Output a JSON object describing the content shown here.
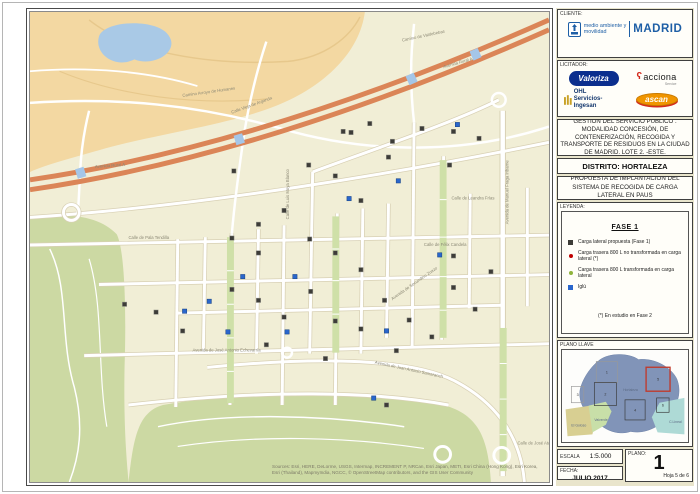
{
  "map": {
    "attribution": "Sources: Esri, HERE, DeLorme, USGS, Intermap, INCREMENT P, NRCan, Esri Japan, METI, Esri China (Hong Kong), Esri Korea, Esri (Thailand), MapmyIndia, NGCC, © OpenStreetMap contributors, and the GIS User Community",
    "colors": {
      "base": "#f1eed6",
      "golf": "#f3d8a2",
      "pond": "#a9c9e6",
      "park": "#ccd9a3",
      "highway": "#db8557",
      "road_casing": "#d8d0b4",
      "marker_dark": "#3d3c38",
      "marker_blue": "#2a66cc"
    },
    "street_labels": [
      {
        "text": "Camino Arroyo de Humanes",
        "x": 155,
        "y": 86,
        "r": -8
      },
      {
        "text": "Camino de Valdebebas",
        "x": 378,
        "y": 30,
        "r": -12
      },
      {
        "text": "Avenida Rural A",
        "x": 66,
        "y": 158,
        "r": -4
      },
      {
        "text": "Avenida Rural A",
        "x": 420,
        "y": 57,
        "r": -16
      },
      {
        "text": "Calle Vieja de Arganda",
        "x": 205,
        "y": 103,
        "r": -20
      },
      {
        "text": "Calle de Pala Tendilla",
        "x": 100,
        "y": 230,
        "r": 0
      },
      {
        "text": "Calle de Leandra Frías",
        "x": 428,
        "y": 190,
        "r": 0
      },
      {
        "text": "Calle de Félix Candela",
        "x": 400,
        "y": 237,
        "r": 0
      },
      {
        "text": "Avenida de Manuel Fraga Iribarne",
        "x": 486,
        "y": 215,
        "r": -90
      },
      {
        "text": "Calle de Luis Moya Blanco",
        "x": 263,
        "y": 210,
        "r": -90
      },
      {
        "text": "Avenida de José Antonio Echevarría",
        "x": 165,
        "y": 344,
        "r": 0
      },
      {
        "text": "Avenida de Juan Antonio Samaranch",
        "x": 350,
        "y": 356,
        "r": 12
      },
      {
        "text": "Avenida de Secundino Zuazo",
        "x": 368,
        "y": 292,
        "r": -35
      },
      {
        "text": "Calle de José Atarés",
        "x": 495,
        "y": 438,
        "r": 0
      }
    ],
    "markers": [
      {
        "type": "carga_lateral",
        "x": 318,
        "y": 121
      },
      {
        "type": "carga_lateral",
        "x": 326,
        "y": 122
      },
      {
        "type": "carga_lateral",
        "x": 345,
        "y": 113
      },
      {
        "type": "carga_lateral",
        "x": 364,
        "y": 147
      },
      {
        "type": "carga_lateral",
        "x": 368,
        "y": 131
      },
      {
        "type": "carga_lateral",
        "x": 398,
        "y": 118
      },
      {
        "type": "carga_lateral",
        "x": 430,
        "y": 121
      },
      {
        "type": "carga_lateral",
        "x": 426,
        "y": 155
      },
      {
        "type": "carga_lateral",
        "x": 456,
        "y": 128
      },
      {
        "type": "carga_lateral",
        "x": 283,
        "y": 155
      },
      {
        "type": "carga_lateral",
        "x": 310,
        "y": 166
      },
      {
        "type": "carga_lateral",
        "x": 336,
        "y": 191
      },
      {
        "type": "carga_lateral",
        "x": 258,
        "y": 201
      },
      {
        "type": "carga_lateral",
        "x": 232,
        "y": 215
      },
      {
        "type": "carga_lateral",
        "x": 205,
        "y": 229
      },
      {
        "type": "carga_lateral",
        "x": 232,
        "y": 244
      },
      {
        "type": "carga_lateral",
        "x": 284,
        "y": 230
      },
      {
        "type": "carga_lateral",
        "x": 310,
        "y": 244
      },
      {
        "type": "carga_lateral",
        "x": 336,
        "y": 261
      },
      {
        "type": "carga_lateral",
        "x": 205,
        "y": 281
      },
      {
        "type": "carga_lateral",
        "x": 232,
        "y": 292
      },
      {
        "type": "carga_lateral",
        "x": 258,
        "y": 309
      },
      {
        "type": "carga_lateral",
        "x": 285,
        "y": 283
      },
      {
        "type": "carga_lateral",
        "x": 310,
        "y": 313
      },
      {
        "type": "carga_lateral",
        "x": 336,
        "y": 321
      },
      {
        "type": "carga_lateral",
        "x": 360,
        "y": 292
      },
      {
        "type": "carga_lateral",
        "x": 385,
        "y": 312
      },
      {
        "type": "carga_lateral",
        "x": 408,
        "y": 329
      },
      {
        "type": "carga_lateral",
        "x": 430,
        "y": 247
      },
      {
        "type": "carga_lateral",
        "x": 430,
        "y": 279
      },
      {
        "type": "carga_lateral",
        "x": 452,
        "y": 301
      },
      {
        "type": "carga_lateral",
        "x": 468,
        "y": 263
      },
      {
        "type": "carga_lateral",
        "x": 372,
        "y": 343
      },
      {
        "type": "carga_lateral",
        "x": 300,
        "y": 351
      },
      {
        "type": "carga_lateral",
        "x": 240,
        "y": 337
      },
      {
        "type": "carga_lateral",
        "x": 155,
        "y": 323
      },
      {
        "type": "carga_lateral",
        "x": 128,
        "y": 304
      },
      {
        "type": "carga_lateral",
        "x": 207,
        "y": 161
      },
      {
        "type": "carga_lateral",
        "x": 96,
        "y": 296
      },
      {
        "type": "carga_lateral",
        "x": 362,
        "y": 398
      },
      {
        "type": "iglu",
        "x": 182,
        "y": 293
      },
      {
        "type": "iglu",
        "x": 157,
        "y": 303
      },
      {
        "type": "iglu",
        "x": 201,
        "y": 324
      },
      {
        "type": "iglu",
        "x": 261,
        "y": 324
      },
      {
        "type": "iglu",
        "x": 362,
        "y": 323
      },
      {
        "type": "iglu",
        "x": 349,
        "y": 391
      },
      {
        "type": "iglu",
        "x": 416,
        "y": 246
      },
      {
        "type": "iglu",
        "x": 216,
        "y": 268
      },
      {
        "type": "iglu",
        "x": 269,
        "y": 268
      },
      {
        "type": "iglu",
        "x": 324,
        "y": 189
      },
      {
        "type": "iglu",
        "x": 374,
        "y": 171
      },
      {
        "type": "iglu",
        "x": 434,
        "y": 114
      }
    ]
  },
  "panel": {
    "cliente": {
      "label": "CLIENTE:",
      "logo_line1": "medio ambiente y",
      "logo_line2": "movilidad",
      "brand": "MADRID"
    },
    "licitador": {
      "label": "LICITADOR:",
      "valoriza": "Valoriza",
      "acciona": "acciona",
      "acciona_sub": "Service",
      "ohl_line1": "OHL",
      "ohl_line2": "Servicios-Ingesan",
      "ascan": "ascan"
    },
    "project_title": "GESTIÓN DEL SERVICIO PÚBLICO . MODALIDAD CONCESIÓN, DE CONTENERIZACIÓN, RECOGIDA Y TRANSPORTE DE RESIDUOS EN LA CIUDAD DE MADRID. LOTE 2. -ESTE.",
    "district": "DISTRITO: HORTALEZA",
    "proposal": "PROPUESTA DE IMPLANTACIÓN DEL SISTEMA DE RECOGIDA DE CARGA LATERAL EN PAUS",
    "legend": {
      "label": "LEYENDA:",
      "phase": "FASE 1",
      "items": [
        {
          "marker": "square",
          "color": "#3d3c38",
          "text": "Carga lateral propuesta (Fase 1)"
        },
        {
          "marker": "dot",
          "color": "#c00000",
          "text": "Carga trasera 800 L no transformada en carga lateral (*)"
        },
        {
          "marker": "dot",
          "color": "#8fb43c",
          "text": "Carga trasera 800 L transformada en carga lateral"
        },
        {
          "marker": "square",
          "color": "#2a66cc",
          "text": "Iglú"
        }
      ],
      "footnote": "(*) En estudio en Fase 2"
    },
    "key_map": {
      "label": "PLANO LLAVE",
      "district_name": "Hortaleza",
      "neighbor_labels": [
        "El Goloso",
        "Valverde",
        "C.Lineal"
      ],
      "sheets": [
        {
          "n": "1",
          "x": 34,
          "y": 12,
          "w": 22,
          "h": 22,
          "active": false
        },
        {
          "n": "2",
          "x": 32,
          "y": 34,
          "w": 23,
          "h": 24,
          "active": false
        },
        {
          "n": "3",
          "x": 8,
          "y": 38,
          "w": 13,
          "h": 17,
          "active": false
        },
        {
          "n": "4",
          "x": 64,
          "y": 52,
          "w": 21,
          "h": 21,
          "active": false
        },
        {
          "n": "5",
          "x": 86,
          "y": 18,
          "w": 25,
          "h": 25,
          "active": true
        },
        {
          "n": "6",
          "x": 97,
          "y": 50,
          "w": 13,
          "h": 15,
          "active": false
        }
      ]
    },
    "escala": {
      "label": "ESCALA",
      "value": "1:5.000"
    },
    "fecha": {
      "label": "FECHA:",
      "value": "JULIO 2017"
    },
    "plano": {
      "label": "PLANO:",
      "number": "1",
      "sheet": "Hoja 5 de 6"
    }
  }
}
